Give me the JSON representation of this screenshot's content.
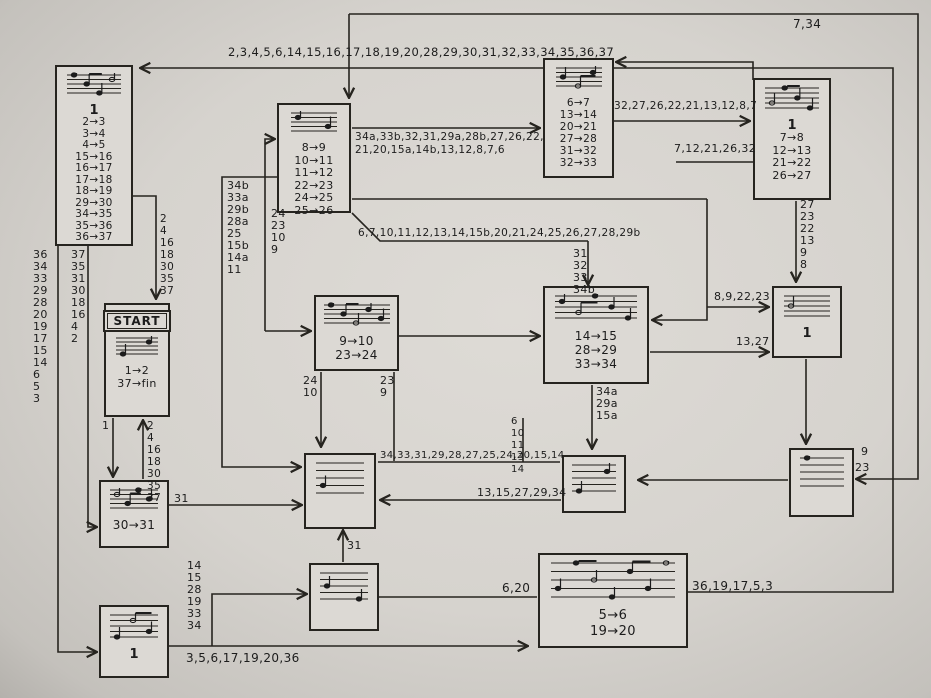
{
  "boxes": {
    "top_left": {
      "number": "1",
      "transitions": [
        "2→3",
        "3→4",
        "4→5",
        "15→16",
        "16→17",
        "17→18",
        "18→19",
        "29→30",
        "34→35",
        "35→36",
        "36→37"
      ]
    },
    "top_center": {
      "transitions": [
        "8→9",
        "10→11",
        "11→12",
        "22→23",
        "24→25",
        "25→26"
      ]
    },
    "top_mid": {
      "transitions": [
        "6→7",
        "13→14",
        "20→21",
        "27→28",
        "31→32",
        "32→33"
      ]
    },
    "top_right": {
      "number": "1",
      "transitions": [
        "7→8",
        "12→13",
        "21→22",
        "26→27"
      ]
    },
    "start": {
      "badge": "START",
      "transitions": [
        "1→2",
        "37→fin"
      ]
    },
    "center": {
      "transitions": [
        "9→10",
        "23→24"
      ]
    },
    "mid_right": {
      "transitions": [
        "14→15",
        "28→29",
        "33→34"
      ]
    },
    "right_mid": {
      "number": "1"
    },
    "center_low": {},
    "low_mid": {},
    "low_right": {},
    "thirty": {
      "transitions": [
        "30→31"
      ]
    },
    "bottom_mid": {},
    "bottom_big": {
      "transitions": [
        "5→6",
        "19→20"
      ]
    },
    "bottom_left": {
      "number": "1"
    }
  },
  "labels": {
    "corner_note": "7,34",
    "top_loop": "2,3,4,5,6,14,15,16,17,18,19,20,28,29,30,31,32,33,34,35,36,37",
    "b_to_c_line1": "34a,33b,32,31,29a,28b,27,26,22,",
    "b_to_c_line2": "21,20,15a,14b,13,12,8,7,6",
    "c_to_d": "32,27,26,22,21,13,12,8,7",
    "d_in": "7,12,21,26,32",
    "d_to_h_col": [
      "27",
      "23",
      "22",
      "13",
      "9",
      "8"
    ],
    "h_in_upper": "8,9,22,23",
    "h_in_lower": "13,27",
    "left_outer_col": [
      "36",
      "34",
      "33",
      "29",
      "28",
      "20",
      "19",
      "17",
      "15",
      "14",
      "6",
      "5",
      "3"
    ],
    "left_inner_col": [
      "37",
      "35",
      "31",
      "30",
      "18",
      "16",
      "4",
      "2"
    ],
    "start_top_col": [
      "2",
      "4",
      "16",
      "18",
      "30",
      "35",
      "37"
    ],
    "start_bottom_col": [
      "2",
      "4",
      "16",
      "18",
      "30",
      "35",
      "37"
    ],
    "ab_col": [
      "34b",
      "33a",
      "29b",
      "28a",
      "25",
      "15b",
      "14a",
      "11"
    ],
    "b_left_col": [
      "24",
      "23",
      "10",
      "9"
    ],
    "b_to_g": "6,7,10,11,12,13,14,15b,20,21,24,25,26,27,28,29b",
    "b_to_g_col": [
      "31",
      "32",
      "33",
      "34b"
    ],
    "f_left_col": [
      "24",
      "10"
    ],
    "f_right_col": [
      "23",
      "9"
    ],
    "g_out_col": [
      "34a",
      "29a",
      "15a"
    ],
    "mid_col": [
      "6",
      "10",
      "11",
      "13",
      "14"
    ],
    "i_out": "34,33,31,29,28,27,25,24,20,15,14",
    "j_to_i": "13,15,27,29,34",
    "k_in_top": "9",
    "k_in_bottom": "23",
    "l_out": "31",
    "m_up": "31",
    "m_in_col": [
      "14",
      "15",
      "28",
      "19",
      "33",
      "34"
    ],
    "m_to_n": "6,20",
    "n_out": "36,19,17,5,3",
    "o_to_n": "3,5,6,17,19,20,36",
    "e_out": "1"
  }
}
